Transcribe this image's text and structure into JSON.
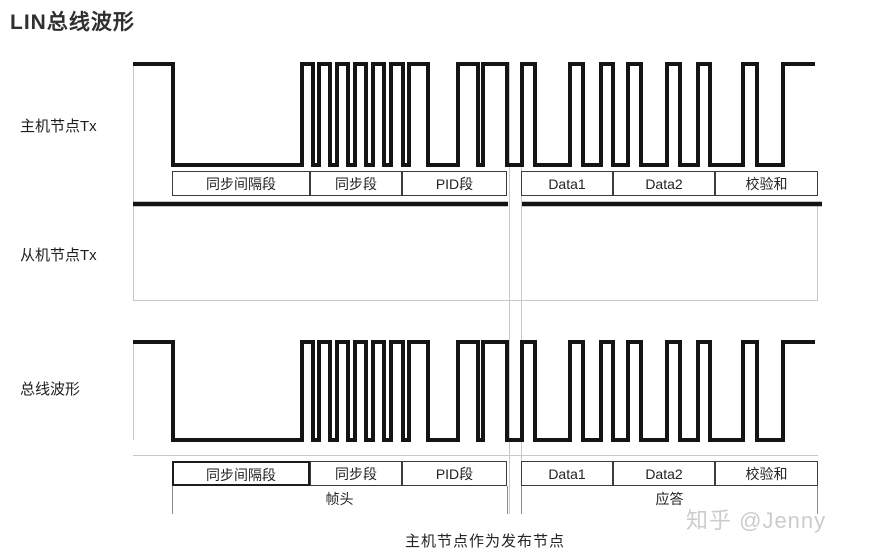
{
  "title": "LIN总线波形",
  "row_labels": {
    "master": "主机节点Tx",
    "slave": "从机节点Tx",
    "bus": "总线波形"
  },
  "segments": {
    "header": [
      "同步间隔段",
      "同步段",
      "PID段"
    ],
    "response": [
      "Data1",
      "Data2",
      "校验和"
    ]
  },
  "groups": {
    "header": "帧头",
    "response": "应答"
  },
  "caption": "主机节点作为发布节点",
  "watermark": "知乎 @Jenny",
  "colors": {
    "waveform": "#141414",
    "box_border": "#3c3c3c",
    "faint_guide": "#c8c8c8",
    "text": "#222222",
    "watermark": "#cccccc"
  },
  "chart_data": {
    "type": "digital-waveform",
    "description": "LIN bus frame timing diagram: master node Tx and resulting bus waveform are identical (sync break low, 0x55 sync field pulses, PID field, then Data1/Data2/checksum bytes); slave node Tx stays recessive (flat high) because the master node acts as publisher.",
    "rows": [
      "主机节点Tx",
      "从机节点Tx (flat recessive high)",
      "总线波形"
    ],
    "x_unit": "px",
    "levels": {
      "high": 1,
      "low": 0
    },
    "transitions": [
      [
        133,
        1
      ],
      [
        173,
        0
      ],
      [
        302,
        1
      ],
      [
        313,
        0
      ],
      [
        319,
        1
      ],
      [
        330,
        0
      ],
      [
        337,
        1
      ],
      [
        348,
        0
      ],
      [
        355,
        1
      ],
      [
        366,
        0
      ],
      [
        373,
        1
      ],
      [
        384,
        0
      ],
      [
        391,
        1
      ],
      [
        403,
        0
      ],
      [
        409,
        1
      ],
      [
        428,
        0
      ],
      [
        458,
        1
      ],
      [
        478,
        0
      ],
      [
        483,
        1
      ],
      [
        507,
        0
      ],
      [
        522,
        1
      ],
      [
        535,
        0
      ],
      [
        570,
        1
      ],
      [
        583,
        0
      ],
      [
        601,
        1
      ],
      [
        613,
        0
      ],
      [
        628,
        1
      ],
      [
        641,
        0
      ],
      [
        667,
        1
      ],
      [
        680,
        0
      ],
      [
        698,
        1
      ],
      [
        710,
        0
      ],
      [
        743,
        1
      ],
      [
        757,
        0
      ],
      [
        783,
        1
      ],
      [
        815,
        1
      ]
    ],
    "segment_x_ranges": {
      "同步间隔段": [
        172,
        310
      ],
      "同步段": [
        310,
        402
      ],
      "PID段": [
        402,
        507
      ],
      "Data1": [
        521,
        613
      ],
      "Data2": [
        613,
        715
      ],
      "校验和": [
        715,
        818
      ]
    },
    "group_x_ranges": {
      "帧头": [
        172,
        507
      ],
      "应答": [
        521,
        818
      ]
    }
  }
}
